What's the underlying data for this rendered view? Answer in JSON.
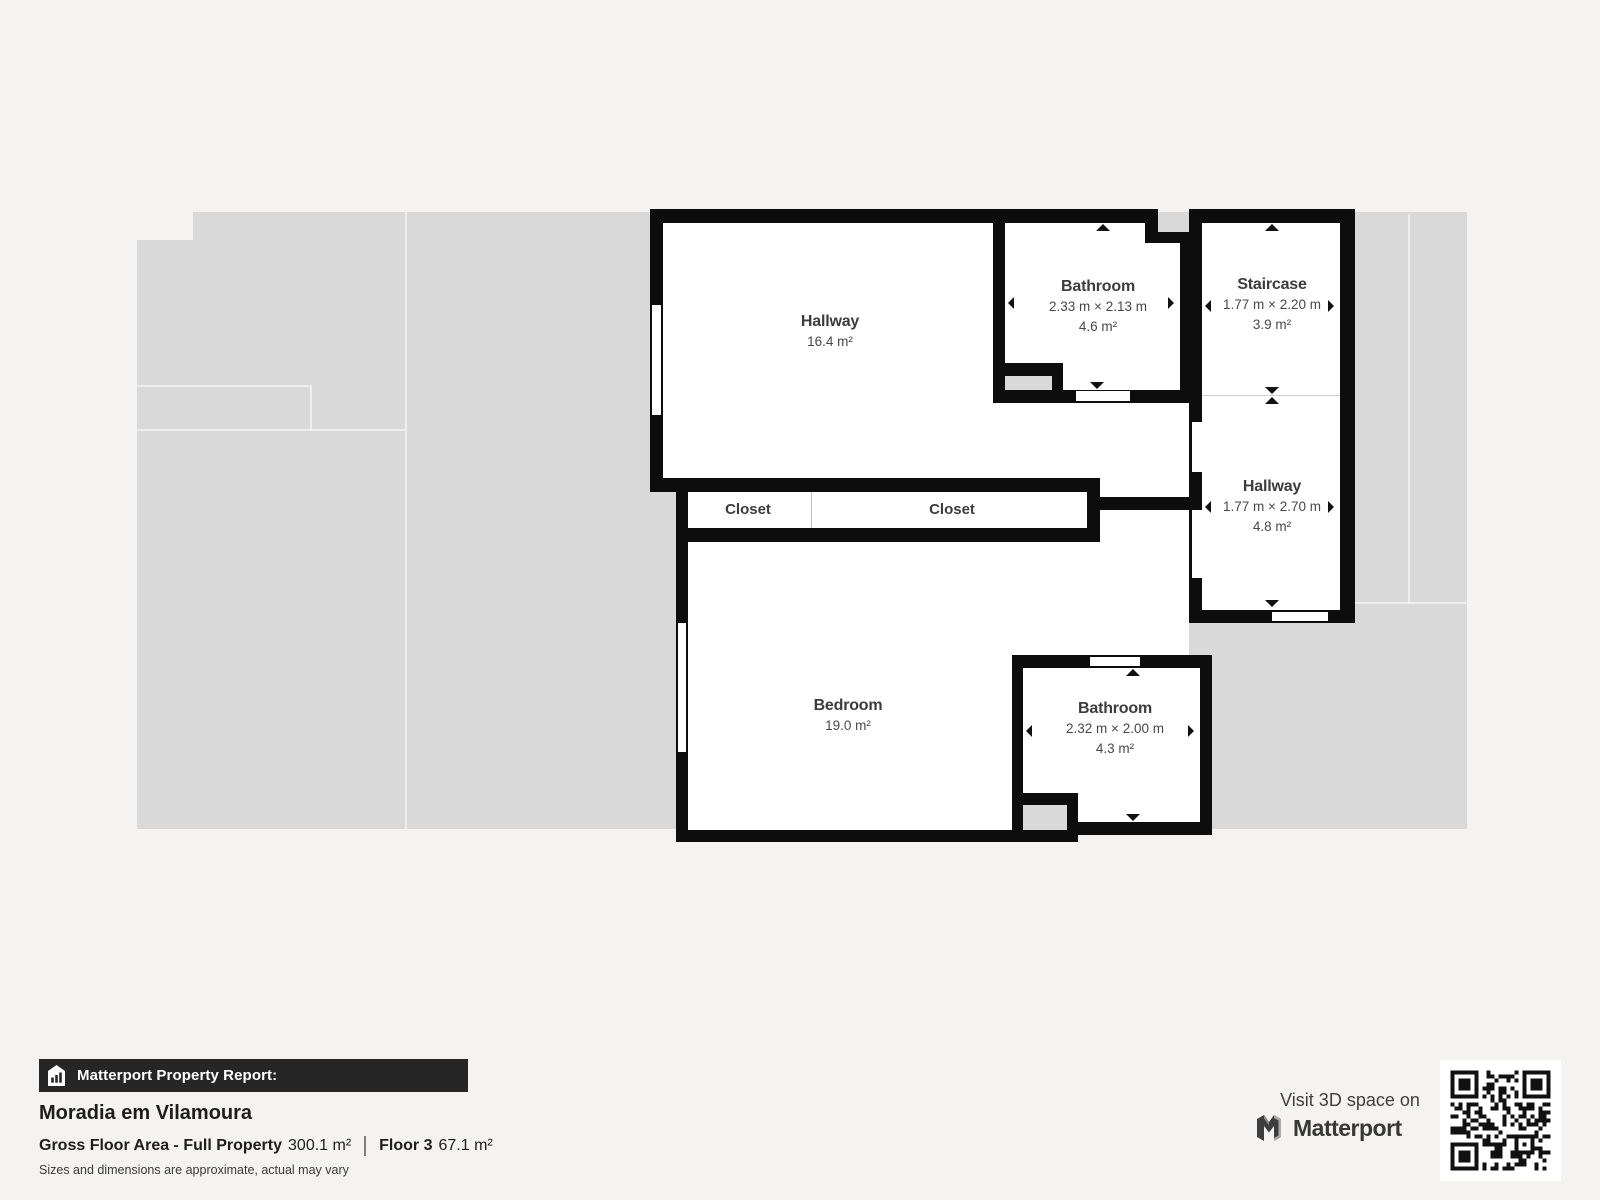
{
  "floorplan": {
    "rooms": {
      "hallway_main": {
        "name": "Hallway",
        "area": "16.4 m²"
      },
      "bathroom_top": {
        "name": "Bathroom",
        "dims": "2.33 m × 2.13 m",
        "area": "4.6 m²"
      },
      "staircase": {
        "name": "Staircase",
        "dims": "1.77 m × 2.20 m",
        "area": "3.9 m²"
      },
      "hallway_right": {
        "name": "Hallway",
        "dims": "1.77 m × 2.70 m",
        "area": "4.8 m²"
      },
      "closet_left": {
        "name": "Closet"
      },
      "closet_right": {
        "name": "Closet"
      },
      "bedroom": {
        "name": "Bedroom",
        "area": "19.0 m²"
      },
      "bathroom_bottom": {
        "name": "Bathroom",
        "dims": "2.32 m × 2.00 m",
        "area": "4.3 m²"
      }
    },
    "colors": {
      "wall": "#0d0d0d",
      "backdrop": "#d9d9d9",
      "page_background": "#f4f3f1",
      "label_text": "#3c3c3c",
      "footer_bar": "#262626"
    },
    "icons": {
      "report": "house-bar-chart-icon",
      "brand": "matterport-m-icon"
    }
  },
  "footer": {
    "report_label": "Matterport Property Report:",
    "property_name": "Moradia em Vilamoura",
    "gross_label": "Gross Floor Area - Full Property",
    "gross_value": "300.1 m²",
    "floor_label": "Floor 3",
    "floor_value": "67.1 m²",
    "disclaimer": "Sizes and dimensions are approximate, actual may vary",
    "visit_text": "Visit 3D space on",
    "brand": "Matterport"
  }
}
